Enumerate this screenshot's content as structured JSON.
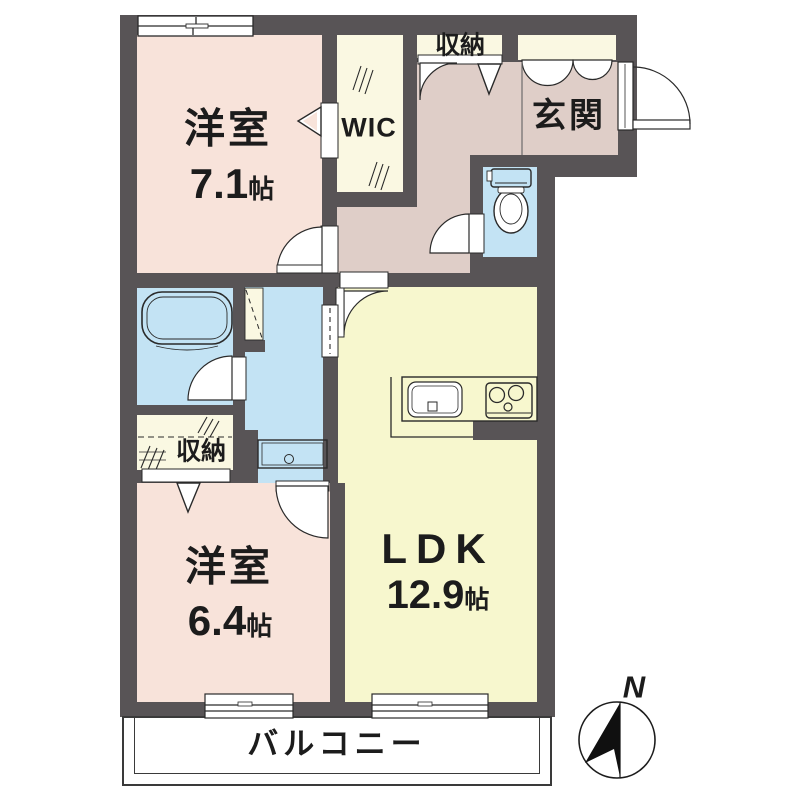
{
  "title": "2LDK apartment floor plan",
  "colors": {
    "wall": "#585456",
    "bedroom_pink": "#F8E3DA",
    "hall_beige": "#DFCEC8",
    "ldk_yellow": "#F7F7CE",
    "closet_cream": "#FAF8E2",
    "water_blue": "#C3E3F4",
    "line": "#2a2a2a"
  },
  "rooms": {
    "bedroom1": {
      "name": "洋室",
      "size": "7.1",
      "unit": "帖"
    },
    "bedroom2": {
      "name": "洋室",
      "size": "6.4",
      "unit": "帖"
    },
    "ldk": {
      "name": "LDK",
      "size": "12.9",
      "unit": "帖"
    },
    "wic": {
      "name": "WIC"
    },
    "closet_top": {
      "name": "収納"
    },
    "closet_mid": {
      "name": "収納"
    },
    "entrance": {
      "name": "玄関"
    },
    "balcony": {
      "name": "バルコニー"
    }
  },
  "compass": {
    "north_label": "N"
  }
}
